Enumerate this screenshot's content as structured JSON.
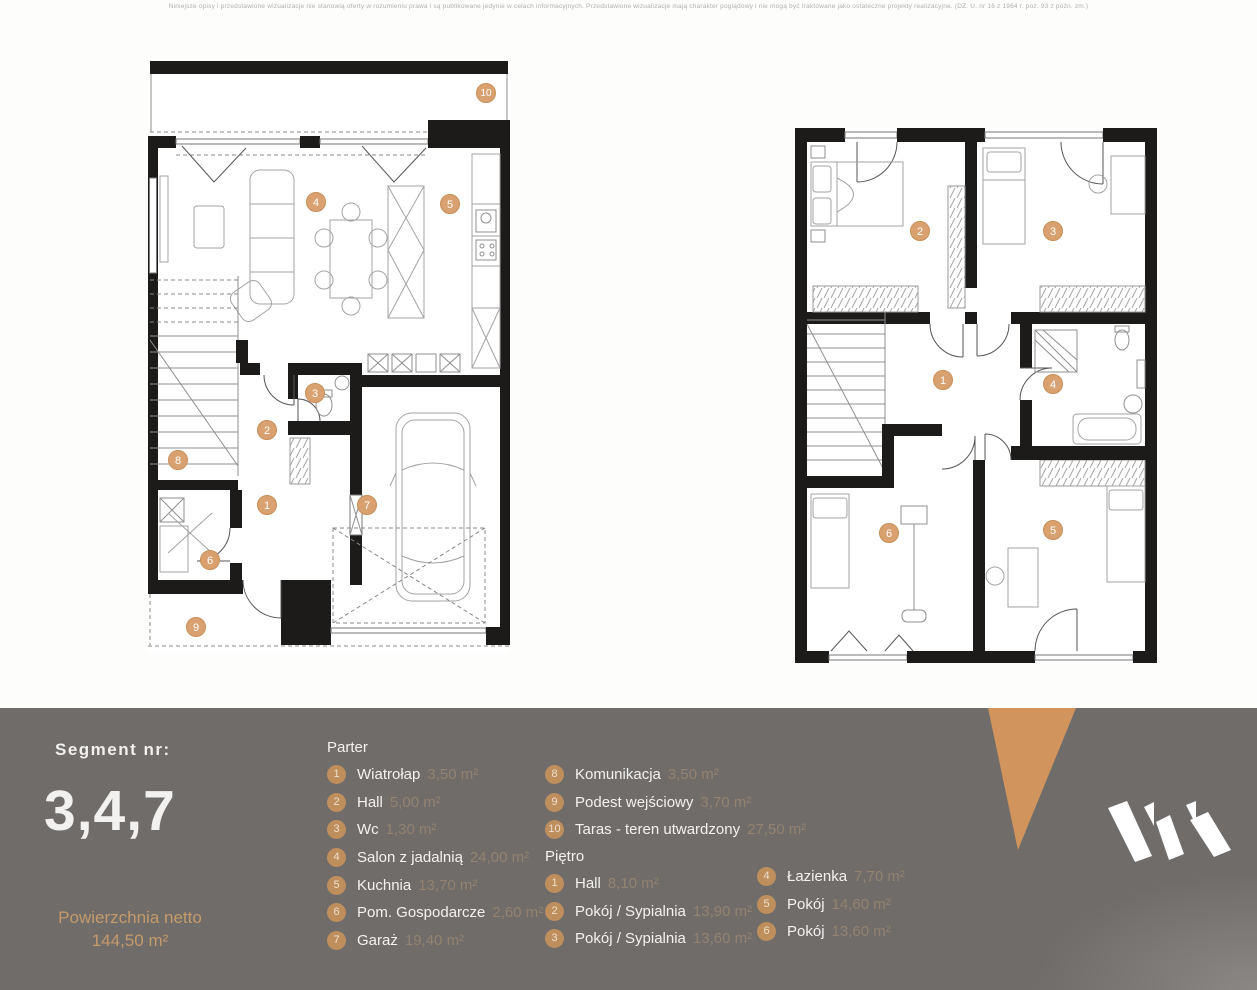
{
  "disclaimer": "Niniejsze opisy i przedstawione wizualizacje nie stanowią oferty w rozumieniu prawa i są publikowane jedynie w celach informacyjnych. Przedstawione wizualizacje mają charakter poglądowy i nie mogą być traktowane jako ostateczne projekty realizacyjne. (DZ. U. nr 16 z 1964 r. poz. 93 z późn. zm.)",
  "segment": {
    "label": "Segment  nr:",
    "value": "3,4,7"
  },
  "area_summary": {
    "label": "Powierzchnia netto",
    "value": "144,50 m²"
  },
  "legend": {
    "parter": {
      "title": "Parter",
      "items": [
        {
          "n": "1",
          "label": "Wiatrołap",
          "area": "3,50 m²"
        },
        {
          "n": "2",
          "label": "Hall",
          "area": "5,00 m²"
        },
        {
          "n": "3",
          "label": "Wc",
          "area": "1,30 m²"
        },
        {
          "n": "4",
          "label": "Salon z jadalnią",
          "area": "24,00 m²"
        },
        {
          "n": "5",
          "label": "Kuchnia",
          "area": "13,70 m²"
        },
        {
          "n": "6",
          "label": "Pom. Gospodarcze",
          "area": "2,60 m²"
        },
        {
          "n": "7",
          "label": "Garaż",
          "area": "19,40 m²"
        },
        {
          "n": "8",
          "label": "Komunikacja",
          "area": "3,50 m²"
        },
        {
          "n": "9",
          "label": "Podest wejściowy",
          "area": "3,70 m²"
        },
        {
          "n": "10",
          "label": "Taras - teren utwardzony",
          "area": "27,50 m²"
        }
      ]
    },
    "pietro": {
      "title": "Piętro",
      "items": [
        {
          "n": "1",
          "label": "Hall",
          "area": "8,10 m²"
        },
        {
          "n": "2",
          "label": "Pokój / Sypialnia",
          "area": "13,90 m²"
        },
        {
          "n": "3",
          "label": "Pokój / Sypialnia",
          "area": "13,60 m²"
        },
        {
          "n": "4",
          "label": "Łazienka",
          "area": "7,70 m²"
        },
        {
          "n": "5",
          "label": "Pokój",
          "area": "14,60 m²"
        },
        {
          "n": "6",
          "label": "Pokój",
          "area": "13,60 m²"
        }
      ]
    }
  },
  "plans": {
    "parter": {
      "name": "Parter",
      "markers": [
        {
          "n": "10",
          "x": 338,
          "y": 35
        },
        {
          "n": "4",
          "x": 168,
          "y": 144
        },
        {
          "n": "5",
          "x": 302,
          "y": 146
        },
        {
          "n": "3",
          "x": 167,
          "y": 335
        },
        {
          "n": "2",
          "x": 119,
          "y": 372
        },
        {
          "n": "8",
          "x": 30,
          "y": 402
        },
        {
          "n": "1",
          "x": 119,
          "y": 447
        },
        {
          "n": "7",
          "x": 219,
          "y": 447
        },
        {
          "n": "6",
          "x": 62,
          "y": 502
        },
        {
          "n": "9",
          "x": 48,
          "y": 569
        }
      ]
    },
    "pietro": {
      "name": "Piętro",
      "markers": [
        {
          "n": "2",
          "x": 125,
          "y": 103
        },
        {
          "n": "3",
          "x": 258,
          "y": 103
        },
        {
          "n": "1",
          "x": 148,
          "y": 252
        },
        {
          "n": "4",
          "x": 258,
          "y": 256
        },
        {
          "n": "6",
          "x": 94,
          "y": 405
        },
        {
          "n": "5",
          "x": 258,
          "y": 402
        }
      ]
    }
  },
  "colors": {
    "footer_bg": "#6f6c6a",
    "accent_tan": "#bf8e5d",
    "marker_tan": "#d9a170",
    "triangle": "#d0945c",
    "wall": "#1d1b19"
  }
}
